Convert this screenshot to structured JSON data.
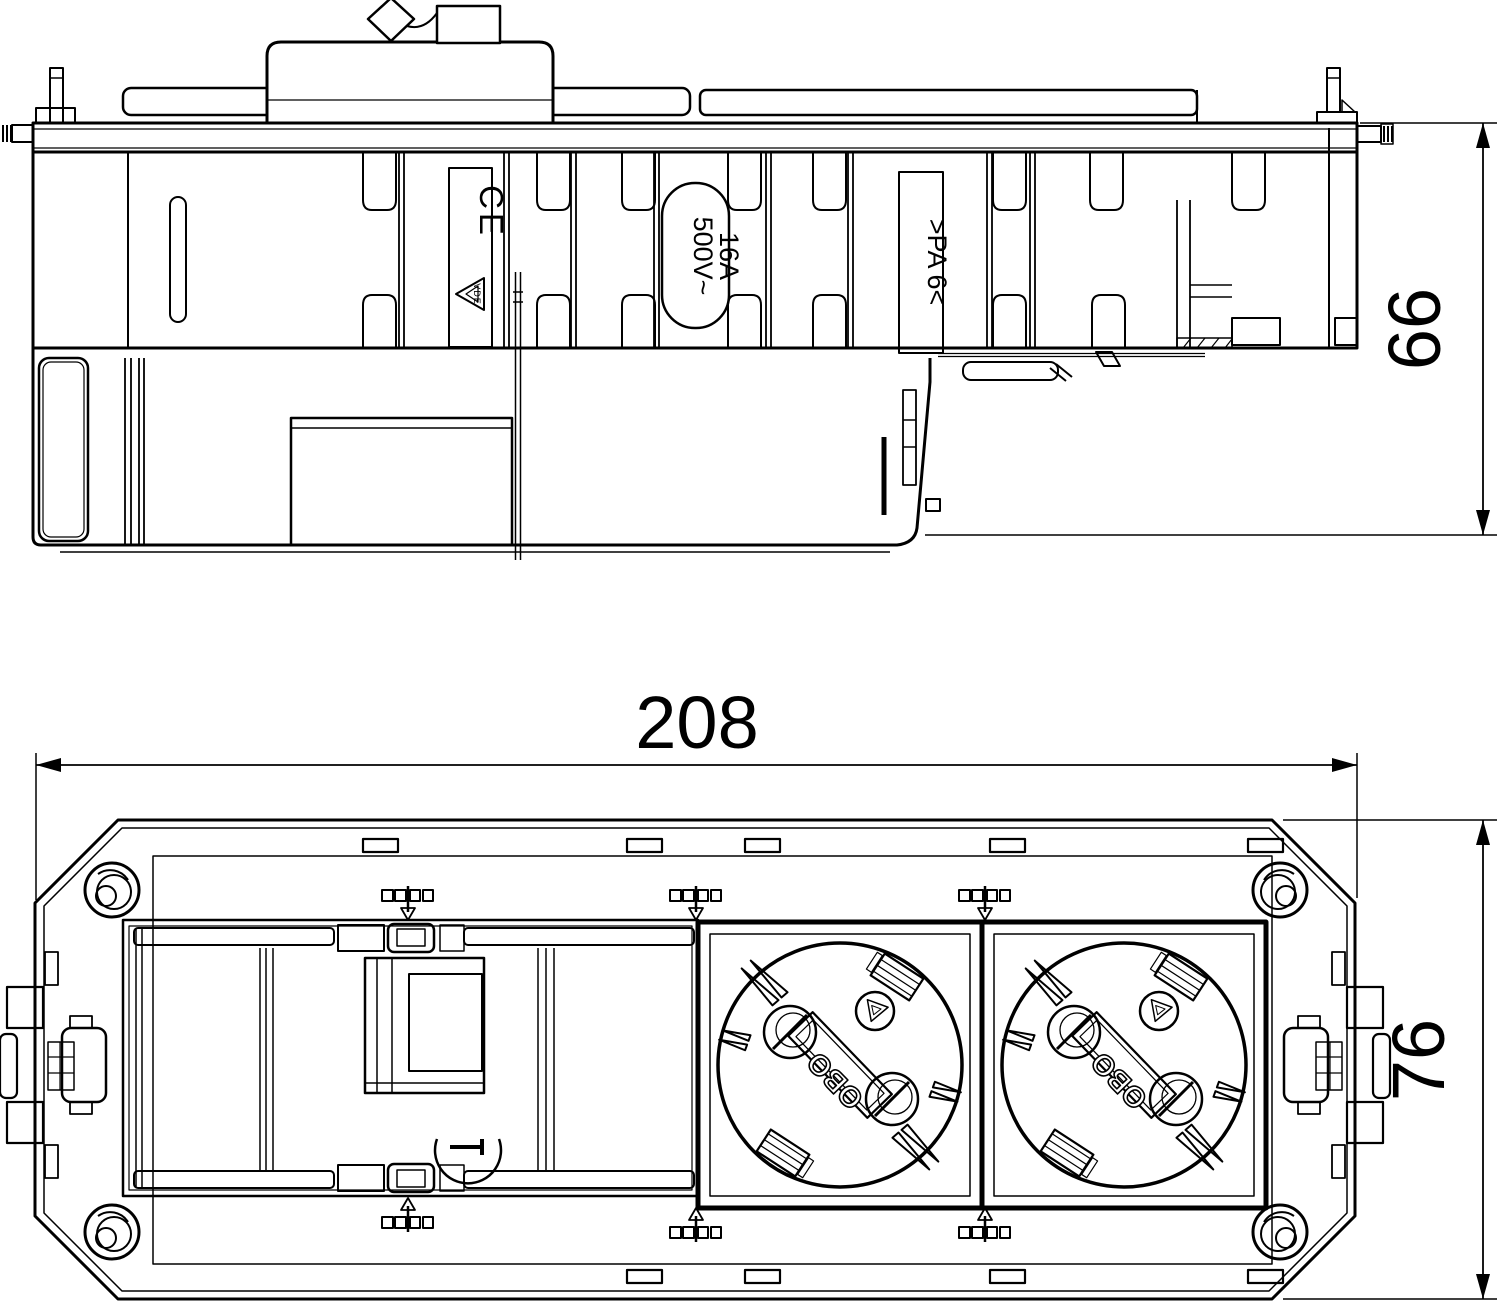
{
  "drawing": {
    "type": "technical-drawing",
    "views": {
      "top": "side-elevation",
      "bottom": "front-plan"
    },
    "colors": {
      "line": "#000000",
      "background": "#ffffff"
    }
  },
  "dimensions": {
    "width_mm": "208",
    "height_mm": "76",
    "depth_mm": "66"
  },
  "markings": {
    "ce": "CE",
    "vde": "VDE",
    "voltage": "500V~",
    "current": "16A",
    "material": ">PA 6<",
    "brand": "OBO"
  },
  "icons": {
    "ce_mark": "conformity-mark",
    "vde_triangle": "certification-mark",
    "screw_boss": "corner-screw",
    "earth_clip": "schuko-earth-contact"
  }
}
